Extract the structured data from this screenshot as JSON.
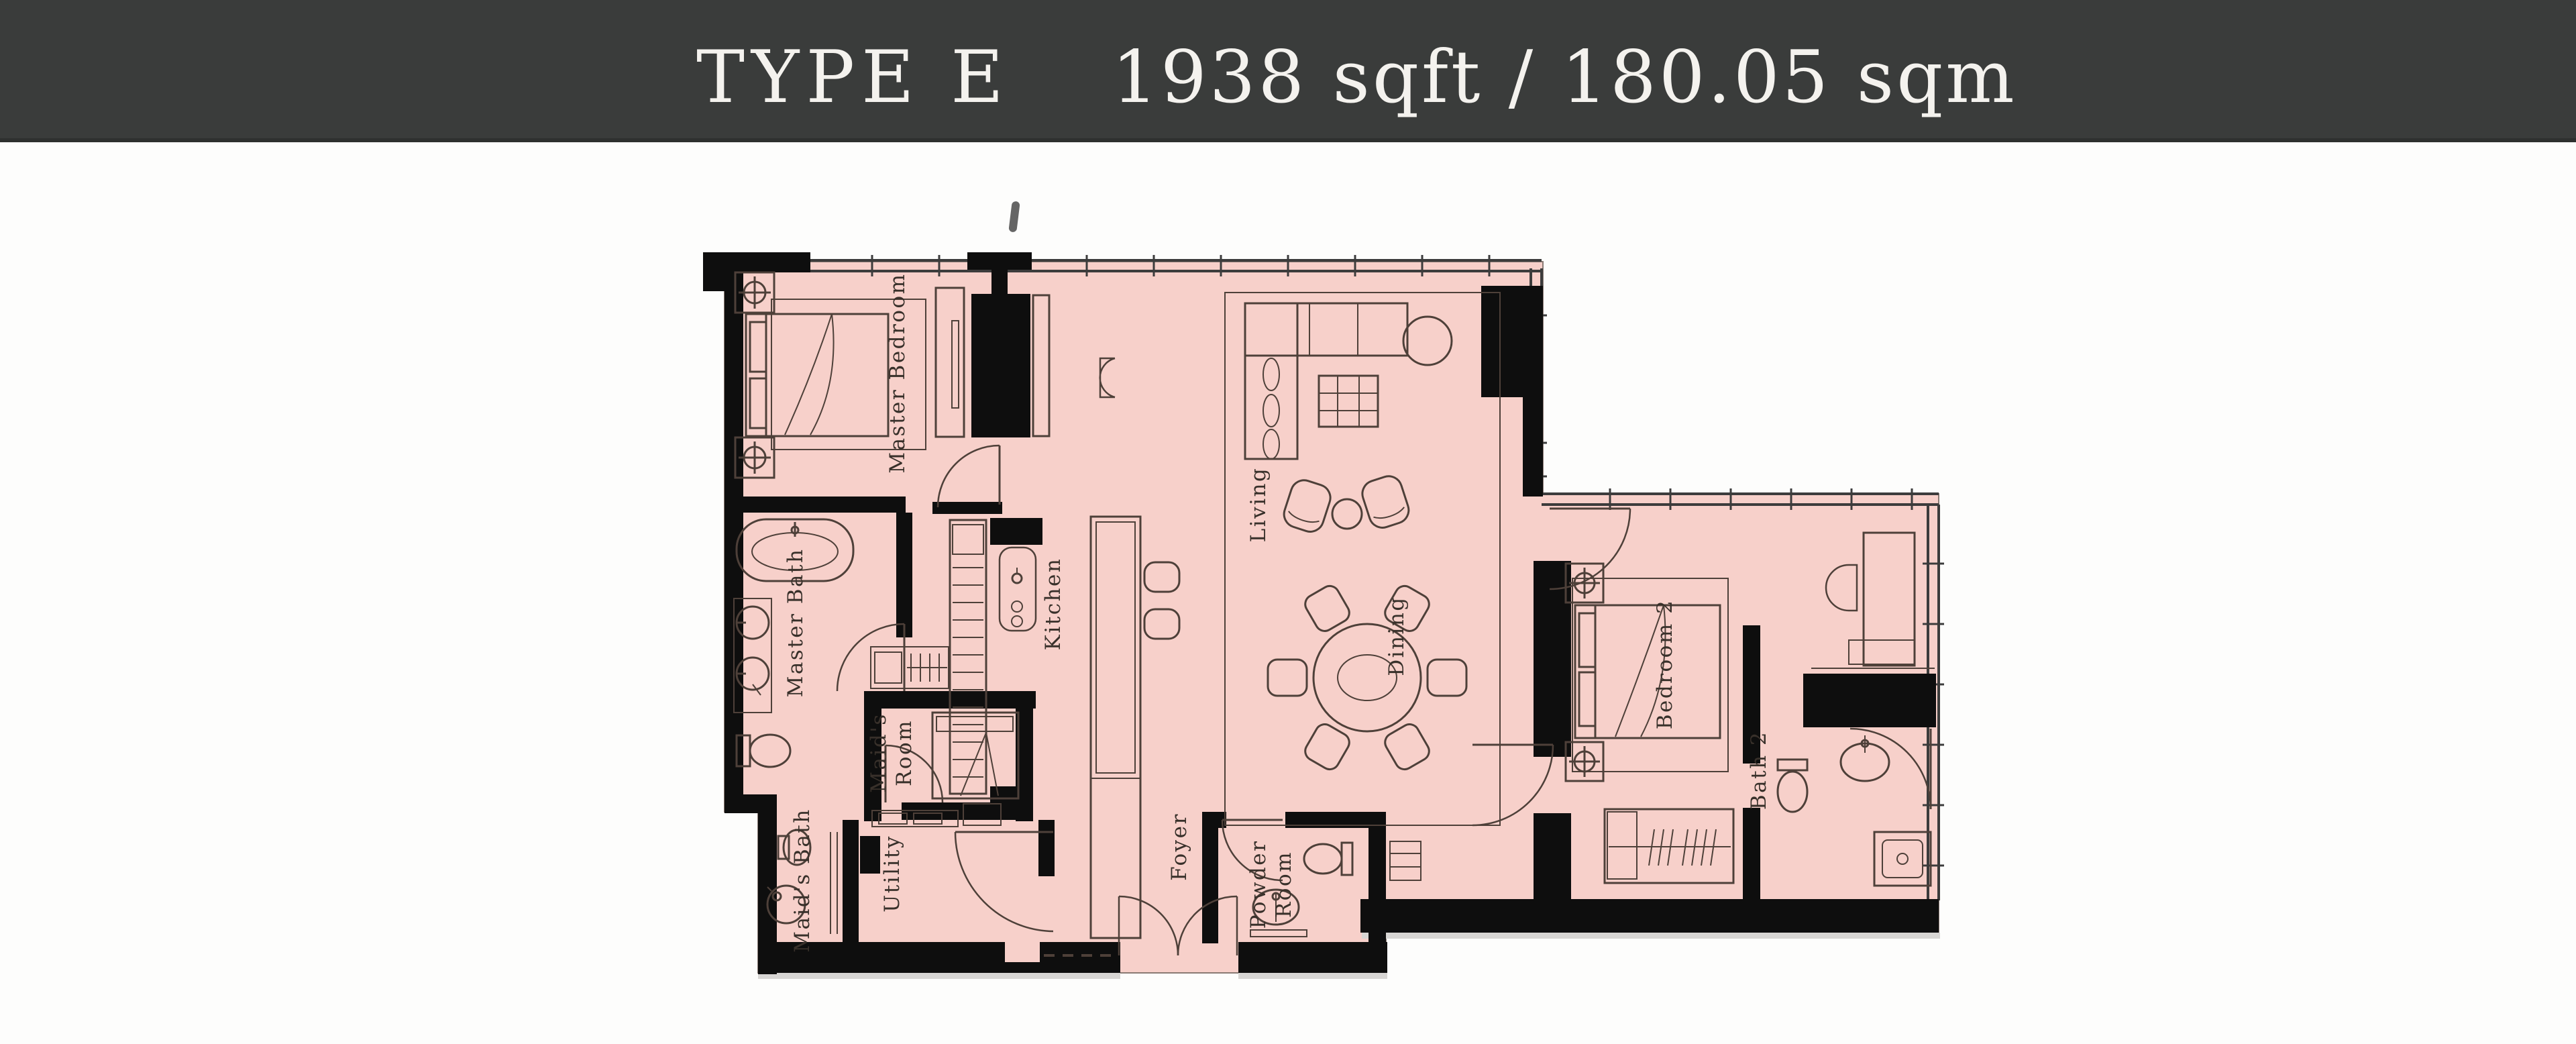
{
  "header": {
    "type_label": "TYPE E",
    "area_label": "1938 sqft / 180.05 sqm"
  },
  "colors": {
    "header_bg": "#3a3c3b",
    "header_text": "#f4f2ee",
    "floor": "#f7d0ca",
    "wall": "#0e0e0e",
    "furniture_line": "#4e4039",
    "glazing_line": "#3c3c3c",
    "label_text": "#38302a",
    "page_bg": "#fdfdfc",
    "shadow": "#d8d6d4"
  },
  "rooms": [
    {
      "id": "master-bedroom",
      "label": "Master Bedroom",
      "lines": [
        "Master Bedroom"
      ]
    },
    {
      "id": "master-bath",
      "label": "Master Bath",
      "lines": [
        "Master Bath"
      ]
    },
    {
      "id": "maids-room",
      "label": "Maid's Room",
      "lines": [
        "Maid's",
        "Room"
      ]
    },
    {
      "id": "kitchen",
      "label": "Kitchen",
      "lines": [
        "Kitchen"
      ]
    },
    {
      "id": "living",
      "label": "Living",
      "lines": [
        "Living"
      ]
    },
    {
      "id": "dining",
      "label": "Dining",
      "lines": [
        "Dining"
      ]
    },
    {
      "id": "foyer",
      "label": "Foyer",
      "lines": [
        "Foyer"
      ]
    },
    {
      "id": "powder-room",
      "label": "Powder Room",
      "lines": [
        "Powder",
        "Room"
      ]
    },
    {
      "id": "utility",
      "label": "Utility",
      "lines": [
        "Utility"
      ]
    },
    {
      "id": "maids-bath",
      "label": "Maid's Bath",
      "lines": [
        "Maid's Bath"
      ]
    },
    {
      "id": "bedroom-2",
      "label": "Bedroom 2",
      "lines": [
        "Bedroom 2"
      ]
    },
    {
      "id": "bath-2",
      "label": "Bath 2",
      "lines": [
        "Bath 2"
      ]
    }
  ]
}
